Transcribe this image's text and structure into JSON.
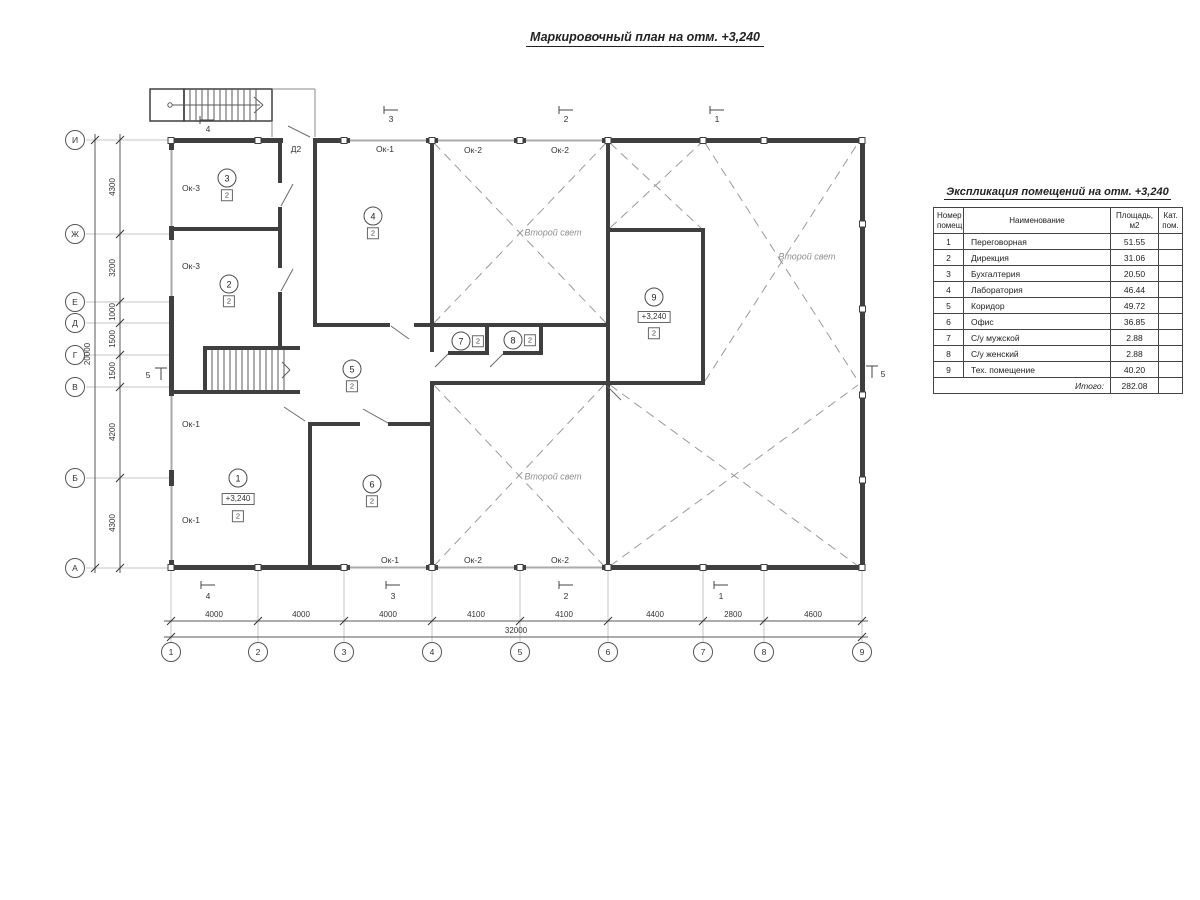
{
  "title": "Маркировочный план на отм. +3,240",
  "colors": {
    "wall": "#3f3f3f",
    "aux_line": "#bdbdbd",
    "dash_line": "#9a9a9a"
  },
  "axis": {
    "rows": [
      "И",
      "Ж",
      "Е",
      "Д",
      "Г",
      "В",
      "Б",
      "А"
    ],
    "cols": [
      "1",
      "2",
      "3",
      "4",
      "5",
      "6",
      "7",
      "8",
      "9"
    ]
  },
  "dims": {
    "h": [
      "4000",
      "4000",
      "4000",
      "4100",
      "4100",
      "4400",
      "2800",
      "4600"
    ],
    "h_total": "32000",
    "v": [
      "4300",
      "3200",
      "1000",
      "1500",
      "1500",
      "4200",
      "4300"
    ],
    "v_total": "20000"
  },
  "labels": {
    "void": "Второй свет",
    "door_top": "Д2",
    "win_left": [
      "Ок-3",
      "Ок-3",
      "Ок-1",
      "Ок-1"
    ],
    "win_top": [
      "Ок-1",
      "Ок-2",
      "Ок-2"
    ],
    "win_bottom": [
      "Ок-1",
      "Ок-2",
      "Ок-2"
    ]
  },
  "markers": {
    "top": [
      "4",
      "3",
      "2",
      "1"
    ],
    "bottom": [
      "4",
      "3",
      "2",
      "1"
    ],
    "left": "5",
    "right": "5"
  },
  "rooms": [
    {
      "num": "1",
      "cat": "2",
      "elev": "+3,240"
    },
    {
      "num": "2",
      "cat": "2"
    },
    {
      "num": "3",
      "cat": "2"
    },
    {
      "num": "4",
      "cat": "2"
    },
    {
      "num": "5",
      "cat": "2"
    },
    {
      "num": "6",
      "cat": "2"
    },
    {
      "num": "7",
      "cat": "2"
    },
    {
      "num": "8",
      "cat": "2"
    },
    {
      "num": "9",
      "cat": "2",
      "elev": "+3,240"
    }
  ],
  "table": {
    "title": "Экспликация помещений на отм. +3,240",
    "headers": {
      "num": "Номер помещ.",
      "name": "Наименование",
      "area": "Площадь, м2",
      "cat": "Кат. пом."
    },
    "rows": [
      {
        "num": "1",
        "name": "Переговорная",
        "area": "51.55",
        "cat": ""
      },
      {
        "num": "2",
        "name": "Дирекция",
        "area": "31.06",
        "cat": ""
      },
      {
        "num": "3",
        "name": "Бухгалтерия",
        "area": "20.50",
        "cat": ""
      },
      {
        "num": "4",
        "name": "Лаборатория",
        "area": "46.44",
        "cat": ""
      },
      {
        "num": "5",
        "name": "Коридор",
        "area": "49.72",
        "cat": ""
      },
      {
        "num": "6",
        "name": "Офис",
        "area": "36.85",
        "cat": ""
      },
      {
        "num": "7",
        "name": "С/у мужской",
        "area": "2.88",
        "cat": ""
      },
      {
        "num": "8",
        "name": "С/у женский",
        "area": "2.88",
        "cat": ""
      },
      {
        "num": "9",
        "name": "Тех. помещение",
        "area": "40.20",
        "cat": ""
      }
    ],
    "total_label": "Итого:",
    "total_area": "282.08"
  }
}
